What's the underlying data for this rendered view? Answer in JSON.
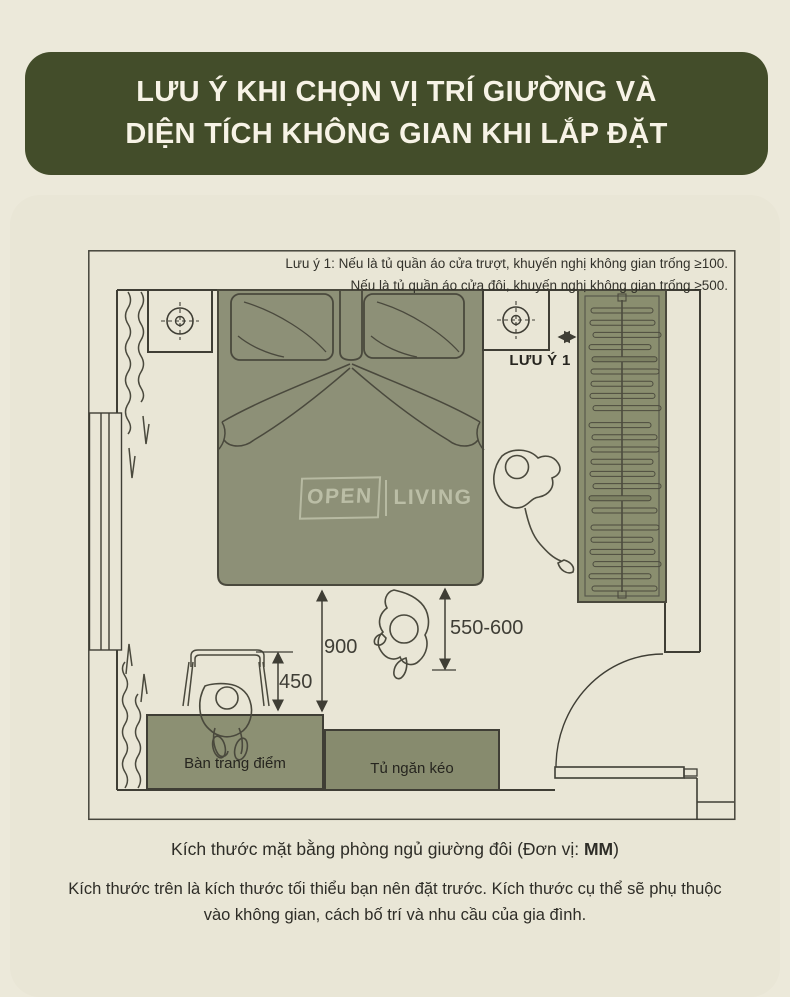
{
  "banner": {
    "title_line1": "LƯU Ý KHI CHỌN VỊ TRÍ GIƯỜNG VÀ",
    "title_line2": "DIỆN TÍCH KHÔNG GIAN KHI LẮP ĐẶT"
  },
  "plan": {
    "note_line1": "Lưu ý 1: Nếu là tủ quần áo cửa trượt, khuyến nghị không gian trống ≥100.",
    "note_line2": "Nếu là tủ quần áo cửa đôi, khuyến nghị không gian trống ≥500.",
    "callout_label": "LƯU Ý 1",
    "dimensions": {
      "bed_to_table": "900",
      "chair_to_table": "450",
      "bed_to_wardrobe_walkway": "550-600"
    },
    "furniture": {
      "dressing_table": "Bàn trang điểm",
      "drawer_cabinet": "Tủ ngăn kéo"
    },
    "wardrobe": {
      "hanger_count": 23
    },
    "watermark": {
      "word1": "OPEN",
      "word2": "LIVING"
    }
  },
  "caption": {
    "prefix": "Kích thước mặt bằng phòng ngủ giường đôi (Đơn vị: ",
    "unit": "MM",
    "suffix": ")"
  },
  "footer_text": "Kích thước trên là kích thước tối thiểu bạn nên đặt trước. Kích thước cụ thể sẽ phụ thuộc vào không gian, cách bố trí và nhu cầu của gia đình.",
  "colors": {
    "page_bg": "#ece9da",
    "card_bg": "#e9e6d6",
    "banner_bg": "#434d2a",
    "banner_text": "#f7f3e6",
    "furniture_fill": "#8d9077",
    "wardrobe_fill": "#8a8e6f",
    "line": "#3f3e35"
  }
}
